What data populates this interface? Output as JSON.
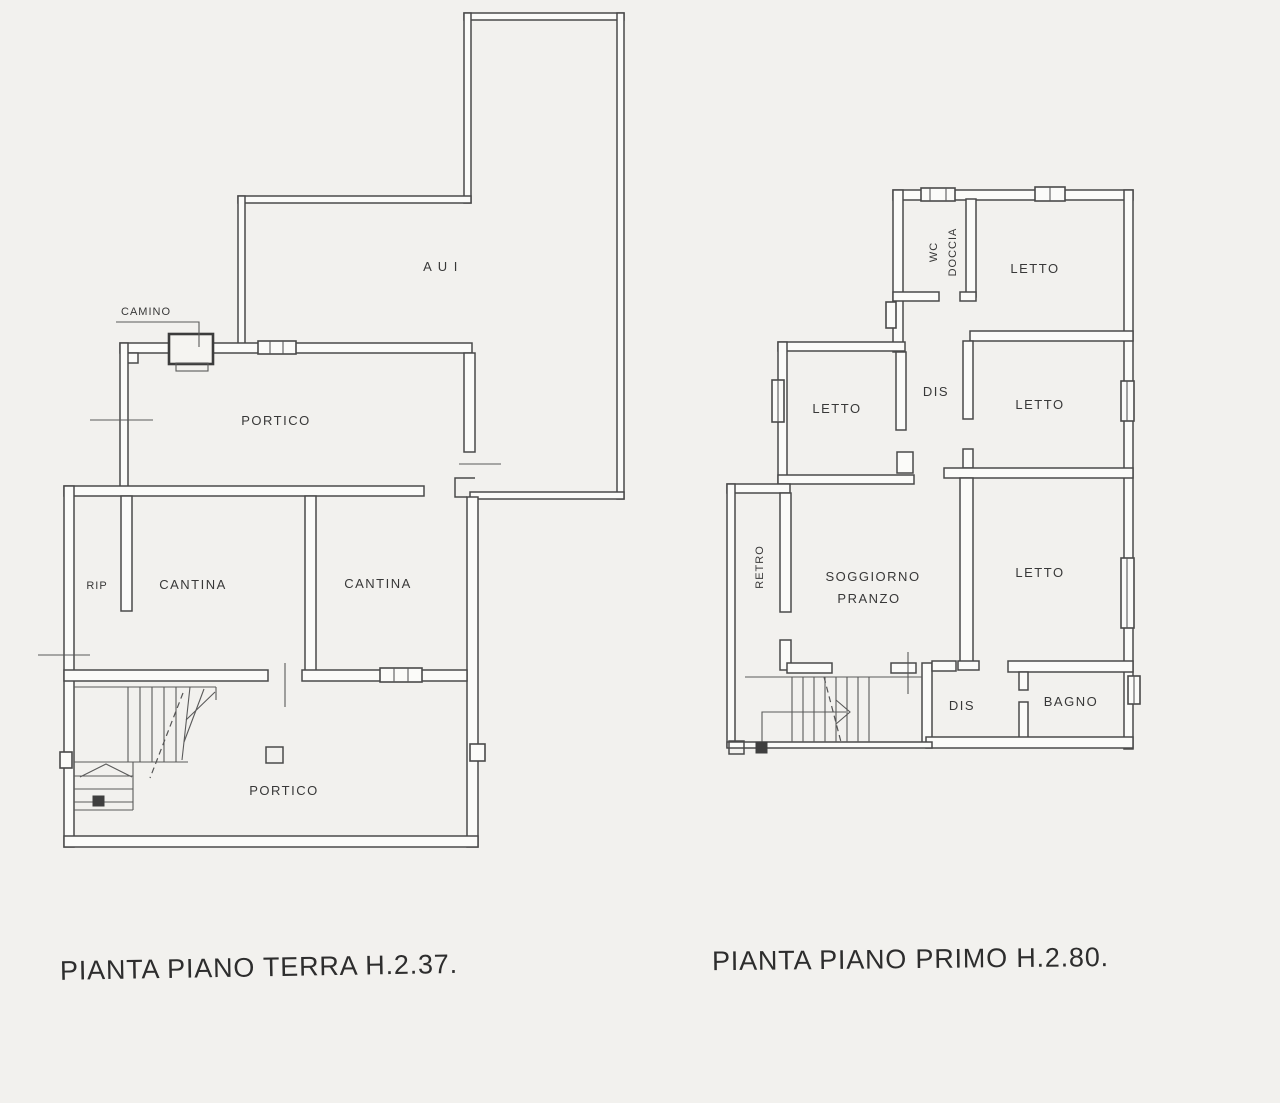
{
  "page": {
    "background_color": "#f2f1ee",
    "ink_color": "#4a4a4a"
  },
  "ground_floor": {
    "caption": "PIANTA PIANO TERRA H.2.37.",
    "labels": {
      "aui": "A U I",
      "camino": "CAMINO",
      "portico_upper": "PORTICO",
      "rip": "RIP",
      "cantina_left": "CANTINA",
      "cantina_right": "CANTINA",
      "portico_lower": "PORTICO"
    }
  },
  "first_floor": {
    "caption": "PIANTA PIANO PRIMO H.2.80.",
    "labels": {
      "wc": "WC",
      "doccia": "DOCCIA",
      "letto_top": "LETTO",
      "dis_upper": "DIS",
      "letto_mid_left": "LETTO",
      "letto_mid_right": "LETTO",
      "retro": "RETRO",
      "soggiorno": "SOGGIORNO",
      "pranzo": "PRANZO",
      "letto_lower": "LETTO",
      "dis_lower": "DIS",
      "bagno": "BAGNO"
    }
  }
}
